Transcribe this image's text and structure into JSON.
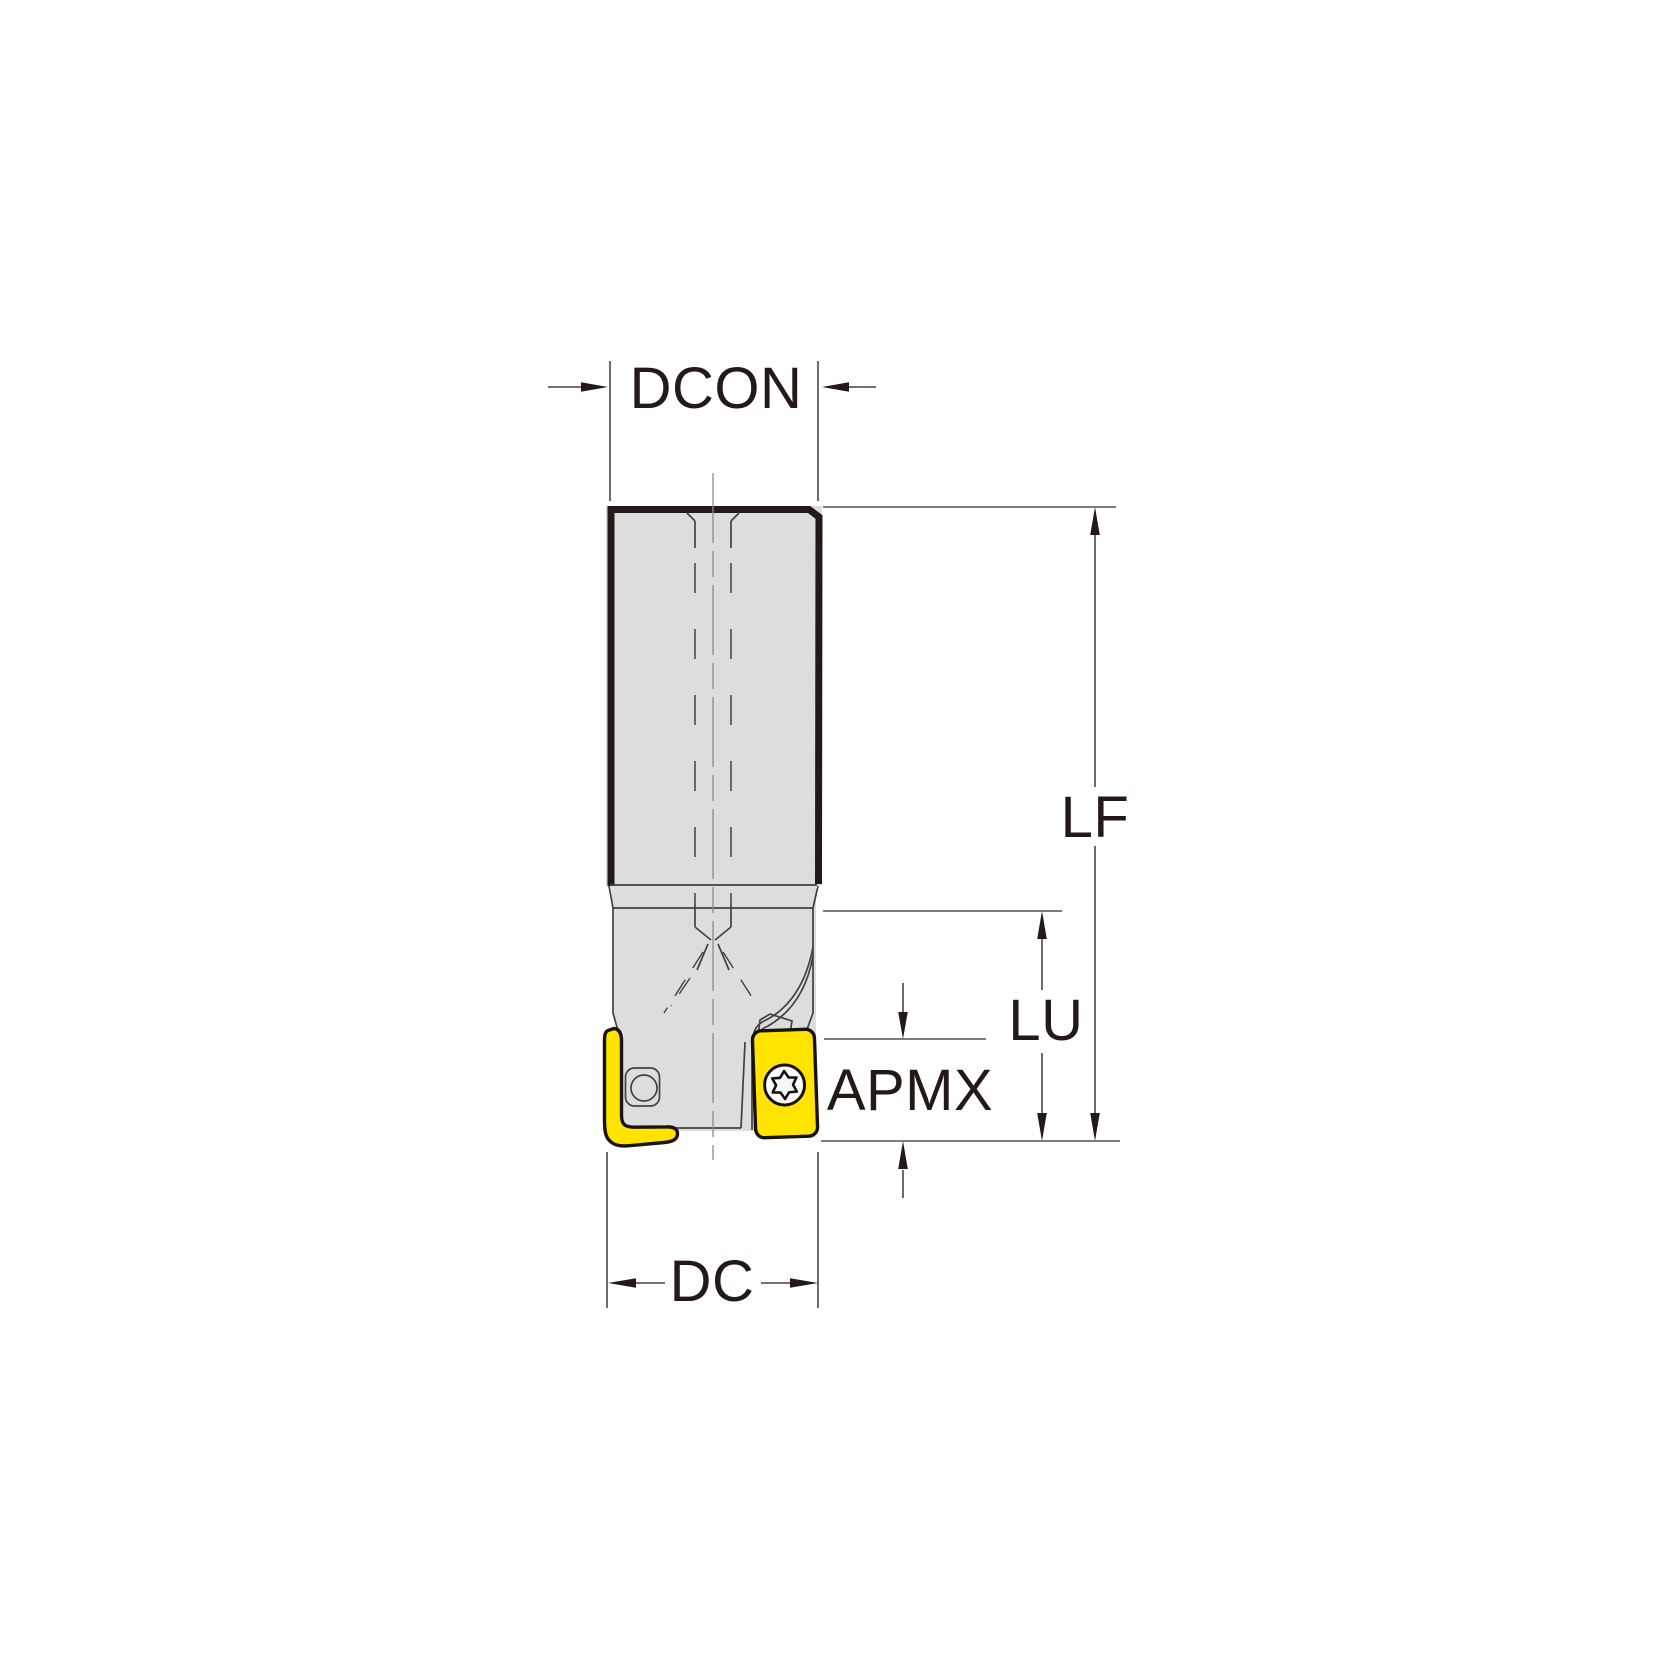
{
  "drawing": {
    "title": "end-mill-dimension-diagram",
    "labels": {
      "dcon": "DCON",
      "lf": "LF",
      "lu": "LU",
      "apmx": "APMX",
      "dc": "DC"
    },
    "colors": {
      "insert_yellow": "#FFE400",
      "body_gray": "#DCDDDD",
      "outline_dark": "#231916",
      "dimension_gray": "#5F5B58",
      "screw_face": "#F6F6F4",
      "background": "#FFFFFF"
    }
  }
}
